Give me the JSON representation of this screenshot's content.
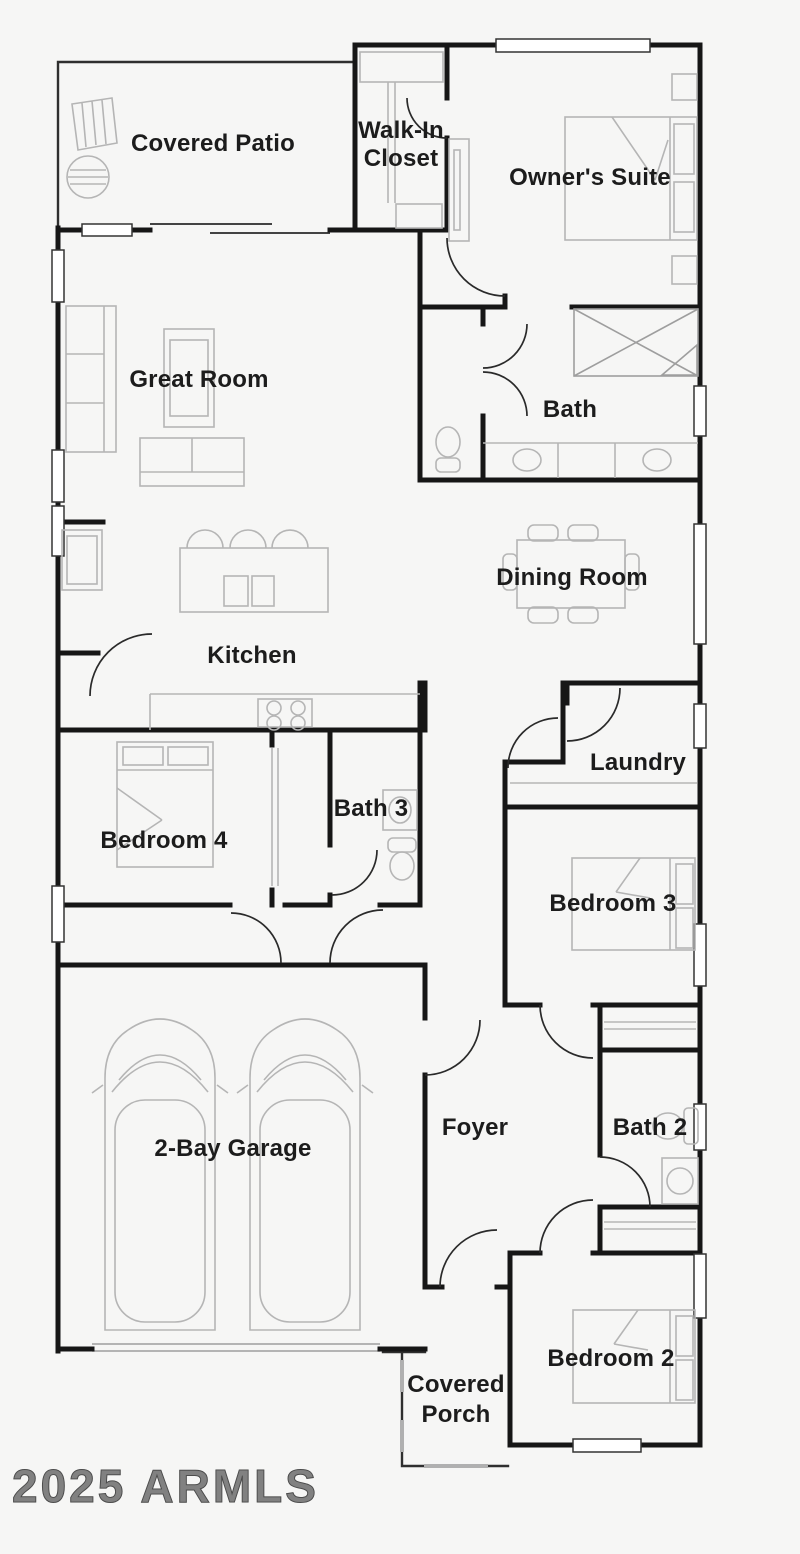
{
  "floorplan": {
    "watermark": {
      "text": "2025 ARMLS"
    },
    "rooms": [
      {
        "name": "covered-patio",
        "label": "Covered Patio"
      },
      {
        "name": "walk-in-closet",
        "lines": [
          "Walk-In",
          "Closet"
        ]
      },
      {
        "name": "owners-suite",
        "label": "Owner's Suite"
      },
      {
        "name": "great-room",
        "label": "Great Room"
      },
      {
        "name": "bath",
        "label": "Bath"
      },
      {
        "name": "dining-room",
        "label": "Dining Room"
      },
      {
        "name": "kitchen",
        "label": "Kitchen"
      },
      {
        "name": "laundry",
        "label": "Laundry"
      },
      {
        "name": "bedroom-4",
        "label": "Bedroom 4"
      },
      {
        "name": "bath-3",
        "label": "Bath 3"
      },
      {
        "name": "bedroom-3",
        "label": "Bedroom 3"
      },
      {
        "name": "two-bay-garage",
        "label": "2-Bay Garage"
      },
      {
        "name": "foyer",
        "label": "Foyer"
      },
      {
        "name": "bath-2",
        "label": "Bath 2"
      },
      {
        "name": "bedroom-2",
        "label": "Bedroom 2"
      },
      {
        "name": "covered-porch",
        "lines": [
          "Covered",
          "Porch"
        ]
      }
    ],
    "colors": {
      "background": "#f6f6f5",
      "wall": "#161616",
      "furniture": "#b5b5b5",
      "fixture": "#9e9e9e",
      "door": "#2a2a2a",
      "text": "#1c1c1c",
      "watermark": "#5a5a5a"
    }
  }
}
